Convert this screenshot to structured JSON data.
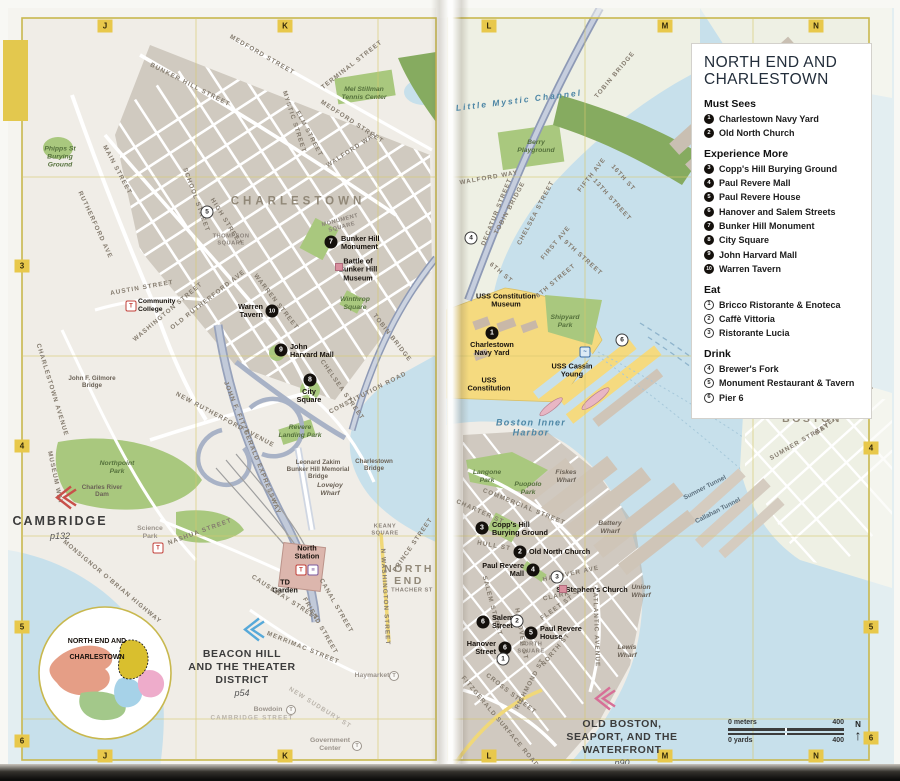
{
  "legend": {
    "title": "NORTH END AND\nCHARLESTOWN",
    "sections": [
      {
        "heading": "Must Sees",
        "style": "filled",
        "items": [
          {
            "n": "1",
            "t": "Charlestown Navy Yard"
          },
          {
            "n": "2",
            "t": "Old North Church"
          }
        ]
      },
      {
        "heading": "Experience More",
        "style": "filled",
        "items": [
          {
            "n": "3",
            "t": "Copp's Hill Burying Ground"
          },
          {
            "n": "4",
            "t": "Paul Revere Mall"
          },
          {
            "n": "5",
            "t": "Paul Revere House"
          },
          {
            "n": "6",
            "t": "Hanover and Salem Streets"
          },
          {
            "n": "7",
            "t": "Bunker Hill Monument"
          },
          {
            "n": "8",
            "t": "City Square"
          },
          {
            "n": "9",
            "t": "John Harvard Mall"
          },
          {
            "n": "10",
            "t": "Warren Tavern"
          }
        ]
      },
      {
        "heading": "Eat",
        "style": "outline",
        "items": [
          {
            "n": "1",
            "t": "Bricco Ristorante & Enoteca"
          },
          {
            "n": "2",
            "t": "Caffè Vittoria"
          },
          {
            "n": "3",
            "t": "Ristorante Lucia"
          }
        ]
      },
      {
        "heading": "Drink",
        "style": "outline",
        "items": [
          {
            "n": "4",
            "t": "Brewer's Fork"
          },
          {
            "n": "5",
            "t": "Monument Restaurant & Tavern"
          },
          {
            "n": "6",
            "t": "Pier 6"
          }
        ]
      }
    ]
  },
  "grid": {
    "top": [
      {
        "t": "J",
        "x": 105
      },
      {
        "t": "K",
        "x": 285
      },
      {
        "t": "L",
        "x": 489
      },
      {
        "t": "M",
        "x": 665
      },
      {
        "t": "N",
        "x": 816
      }
    ],
    "bottom": [
      {
        "t": "J",
        "x": 105
      },
      {
        "t": "K",
        "x": 285
      },
      {
        "t": "L",
        "x": 489
      },
      {
        "t": "M",
        "x": 665
      },
      {
        "t": "N",
        "x": 816
      }
    ],
    "left": [
      {
        "t": "3",
        "y": 266
      },
      {
        "t": "4",
        "y": 446
      },
      {
        "t": "5",
        "y": 627
      },
      {
        "t": "6",
        "y": 741
      }
    ],
    "right": [
      {
        "t": "4",
        "y": 448
      },
      {
        "t": "5",
        "y": 627
      },
      {
        "t": "6",
        "y": 738
      }
    ]
  },
  "scalebar": {
    "meters_left": "0 meters",
    "meters_right": "400",
    "yards_left": "0 yards",
    "yards_right": "400",
    "north": "N",
    "arrow": "↑"
  },
  "inset": {
    "title_line1": "NORTH END AND",
    "title_line2": "CHARLESTOWN"
  },
  "cross_refs": [
    {
      "name": "CAMBRIDGE",
      "page": "p132",
      "x": 60,
      "y": 514,
      "cx": 64,
      "cy": 500,
      "color": "#c8504a",
      "big": true
    },
    {
      "name": "BEACON HILL\nAND THE THEATER\nDISTRICT",
      "page": "p54",
      "x": 242,
      "y": 648,
      "cx": 252,
      "cy": 632,
      "color": "#57a9d9",
      "big": false
    },
    {
      "name": "OLD BOSTON,\nSEAPORT, AND THE\nWATERFRONT",
      "page": "p90",
      "x": 622,
      "y": 718,
      "cx": 603,
      "cy": 701,
      "color": "#d76f97",
      "big": false
    }
  ],
  "labels": [
    {
      "t": "CHARLESTOWN",
      "x": 298,
      "y": 202,
      "c": "district"
    },
    {
      "t": "NORTH\nEND",
      "x": 409,
      "y": 575,
      "c": "district2"
    },
    {
      "t": "EAST\nBOSTON",
      "x": 812,
      "y": 413,
      "c": "district2"
    },
    {
      "t": "Little Mystic Channel",
      "x": 519,
      "y": 101,
      "c": "water",
      "r": -7
    },
    {
      "t": "Boston Inner\nHarbor",
      "x": 531,
      "y": 428,
      "c": "water2"
    },
    {
      "t": "Mel Stillman\nTennis Center",
      "x": 364,
      "y": 94,
      "c": "park"
    },
    {
      "t": "Phipps St\nBurying\nGround",
      "x": 60,
      "y": 157,
      "c": "park"
    },
    {
      "t": "Winthrop\nSquare",
      "x": 355,
      "y": 304,
      "c": "park"
    },
    {
      "t": "Northpoint\nPark",
      "x": 117,
      "y": 468,
      "c": "park"
    },
    {
      "t": "Revere\nLanding Park",
      "x": 300,
      "y": 432,
      "c": "park"
    },
    {
      "t": "Berry\nPlayground",
      "x": 536,
      "y": 147,
      "c": "park"
    },
    {
      "t": "Shipyard\nPark",
      "x": 565,
      "y": 322,
      "c": "park"
    },
    {
      "t": "Langone\nPark",
      "x": 487,
      "y": 477,
      "c": "park"
    },
    {
      "t": "Puopolo\nPark",
      "x": 528,
      "y": 489,
      "c": "park"
    },
    {
      "t": "Lovejoy\nWharf",
      "x": 330,
      "y": 490,
      "c": "wharf"
    },
    {
      "t": "Fiskes\nWharf",
      "x": 566,
      "y": 477,
      "c": "wharf"
    },
    {
      "t": "Battery\nWharf",
      "x": 610,
      "y": 528,
      "c": "wharf"
    },
    {
      "t": "Union\nWharf",
      "x": 641,
      "y": 592,
      "c": "wharf"
    },
    {
      "t": "Lewis\nWharf",
      "x": 627,
      "y": 652,
      "c": "wharf"
    },
    {
      "t": "John F. Gilmore\nBridge",
      "x": 92,
      "y": 382,
      "c": "bridge"
    },
    {
      "t": "Charles River\nDam",
      "x": 102,
      "y": 491,
      "c": "bridge"
    },
    {
      "t": "Leonard Zakim\nBunker Hill Memorial\nBridge",
      "x": 318,
      "y": 470,
      "c": "bridge"
    },
    {
      "t": "Charlestown\nBridge",
      "x": 374,
      "y": 465,
      "c": "bridge"
    },
    {
      "t": "Battle of\nBunker Hill\nMuseum",
      "x": 358,
      "y": 270,
      "c": "poi"
    },
    {
      "t": "USS Constitution\nMuseum",
      "x": 506,
      "y": 301,
      "c": "poi"
    },
    {
      "t": "USS Cassin\nYoung",
      "x": 572,
      "y": 371,
      "c": "poi"
    },
    {
      "t": "USS\nConstitution",
      "x": 489,
      "y": 385,
      "c": "poi"
    },
    {
      "t": "St Stephen's Church",
      "x": 592,
      "y": 590,
      "c": "poi"
    },
    {
      "t": "TD\nGarden",
      "x": 285,
      "y": 587,
      "c": "poi"
    },
    {
      "t": "North\nStation",
      "x": 307,
      "y": 553,
      "c": "poi"
    },
    {
      "t": "NORTH\nSQUARE",
      "x": 531,
      "y": 648,
      "c": "squareLbl"
    },
    {
      "t": "THOMPSON\nSQUARE",
      "x": 231,
      "y": 240,
      "c": "squareLbl"
    },
    {
      "t": "MONUMENT\nSQUARE",
      "x": 341,
      "y": 224,
      "c": "squareLbl",
      "r": -15
    },
    {
      "t": "KEANY\nSQUARE",
      "x": 385,
      "y": 530,
      "c": "squareLbl"
    },
    {
      "t": "THACHER ST",
      "x": 412,
      "y": 591,
      "c": "squareLbl"
    },
    {
      "t": "Sumner Tunnel",
      "x": 705,
      "y": 488,
      "c": "tunnel",
      "r": -27
    },
    {
      "t": "Callahan Tunnel",
      "x": 718,
      "y": 511,
      "c": "tunnel",
      "r": -27
    },
    {
      "t": "MAIN STREET",
      "x": 117,
      "y": 170,
      "c": "street",
      "r": 62
    },
    {
      "t": "RUTHERFORD AVE",
      "x": 95,
      "y": 225,
      "c": "street",
      "r": 65
    },
    {
      "t": "BUNKER HILL STREET",
      "x": 190,
      "y": 85,
      "c": "street",
      "r": 27
    },
    {
      "t": "MEDFORD STREET",
      "x": 262,
      "y": 55,
      "c": "street",
      "r": 30
    },
    {
      "t": "MEDFORD STREET",
      "x": 352,
      "y": 122,
      "c": "street",
      "r": 33
    },
    {
      "t": "TERMINAL STREET",
      "x": 352,
      "y": 65,
      "c": "street",
      "r": -38
    },
    {
      "t": "MYSTIC STREET",
      "x": 294,
      "y": 122,
      "c": "street",
      "r": 72
    },
    {
      "t": "ELM STREET",
      "x": 309,
      "y": 134,
      "c": "street",
      "r": 62
    },
    {
      "t": "WALFORD WAY",
      "x": 352,
      "y": 150,
      "c": "street",
      "r": -33
    },
    {
      "t": "SCHOOL STREET",
      "x": 196,
      "y": 200,
      "c": "street",
      "r": 70
    },
    {
      "t": "HIGH STREET",
      "x": 226,
      "y": 222,
      "c": "street",
      "r": 58
    },
    {
      "t": "WARREN STREET",
      "x": 276,
      "y": 302,
      "c": "street",
      "r": 52
    },
    {
      "t": "AUSTIN STREET",
      "x": 142,
      "y": 288,
      "c": "street",
      "r": -10
    },
    {
      "t": "OLD RUTHERFORD AVE",
      "x": 208,
      "y": 300,
      "c": "street",
      "r": -38
    },
    {
      "t": "WASHINGTON STREET",
      "x": 168,
      "y": 312,
      "c": "street",
      "r": -40
    },
    {
      "t": "NEW RUTHERFORD AVENUE",
      "x": 225,
      "y": 420,
      "c": "street",
      "r": 28
    },
    {
      "t": "JOHN F. FITZGERALD EXPRESSWAY",
      "x": 252,
      "y": 448,
      "c": "street",
      "r": 68
    },
    {
      "t": "TOBIN BRIDGE",
      "x": 392,
      "y": 338,
      "c": "street",
      "r": 52
    },
    {
      "t": "CHELSEA STREET",
      "x": 342,
      "y": 390,
      "c": "street",
      "r": 55
    },
    {
      "t": "CONSTITUTION ROAD",
      "x": 368,
      "y": 393,
      "c": "street",
      "r": -27
    },
    {
      "t": "CHARLESTOWN AVENUE",
      "x": 52,
      "y": 390,
      "c": "street",
      "r": 73
    },
    {
      "t": "MUSEUM WAY",
      "x": 55,
      "y": 478,
      "c": "street",
      "r": 78
    },
    {
      "t": "MONSIGNOR O'BRIAN HIGHWAY",
      "x": 112,
      "y": 582,
      "c": "street",
      "r": 40
    },
    {
      "t": "NASHUA STREET",
      "x": 200,
      "y": 532,
      "c": "street",
      "r": -20
    },
    {
      "t": "CAUSEWAY STREET",
      "x": 285,
      "y": 598,
      "c": "street",
      "r": 33
    },
    {
      "t": "MERRIMAC STREET",
      "x": 303,
      "y": 648,
      "c": "street",
      "r": 22
    },
    {
      "t": "CANAL STREET",
      "x": 336,
      "y": 606,
      "c": "street",
      "r": 60
    },
    {
      "t": "FRIEND STREET",
      "x": 320,
      "y": 626,
      "c": "street",
      "r": 60
    },
    {
      "t": "N WASHINGTON STREET",
      "x": 385,
      "y": 597,
      "c": "street",
      "r": 87
    },
    {
      "t": "PRINCE STREET",
      "x": 413,
      "y": 545,
      "c": "street",
      "r": -55
    },
    {
      "t": "CAMBRIDGE STREET",
      "x": 252,
      "y": 718,
      "c": "streetFaded"
    },
    {
      "t": "NEW SUDBURY ST",
      "x": 320,
      "y": 708,
      "c": "streetFaded",
      "r": 32
    },
    {
      "t": "TOBIN BRIDGE",
      "x": 615,
      "y": 75,
      "c": "street",
      "r": -50
    },
    {
      "t": "TOBIN BRIDGE",
      "x": 510,
      "y": 208,
      "c": "street",
      "r": -62
    },
    {
      "t": "CHELSEA STREET",
      "x": 536,
      "y": 213,
      "c": "street",
      "r": -62
    },
    {
      "t": "WALFORD WAY",
      "x": 489,
      "y": 178,
      "c": "street",
      "r": -10
    },
    {
      "t": "DECATUR STREET",
      "x": 497,
      "y": 212,
      "c": "street",
      "r": -68
    },
    {
      "t": "FIFTH AVE",
      "x": 592,
      "y": 175,
      "c": "street",
      "r": -52
    },
    {
      "t": "FIRST AVE",
      "x": 556,
      "y": 243,
      "c": "street",
      "r": -50
    },
    {
      "t": "13TH STREET",
      "x": 612,
      "y": 200,
      "c": "street",
      "r": 48
    },
    {
      "t": "16TH ST",
      "x": 623,
      "y": 178,
      "c": "street",
      "r": 48
    },
    {
      "t": "9TH STREET",
      "x": 583,
      "y": 258,
      "c": "street",
      "r": 42
    },
    {
      "t": "8TH STREET",
      "x": 556,
      "y": 281,
      "c": "street",
      "r": -40
    },
    {
      "t": "6TH ST",
      "x": 501,
      "y": 273,
      "c": "street",
      "r": 40
    },
    {
      "t": "COMMERCIAL STREET",
      "x": 524,
      "y": 507,
      "c": "street",
      "r": 22
    },
    {
      "t": "CHARTER ST",
      "x": 480,
      "y": 512,
      "c": "street",
      "r": 24
    },
    {
      "t": "HULL ST",
      "x": 494,
      "y": 546,
      "c": "street",
      "r": 10
    },
    {
      "t": "SALEM STREET",
      "x": 492,
      "y": 606,
      "c": "street",
      "r": 75
    },
    {
      "t": "HANOVER ST",
      "x": 521,
      "y": 634,
      "c": "street",
      "r": 80
    },
    {
      "t": "HANOVER AVE",
      "x": 571,
      "y": 574,
      "c": "street",
      "r": -12
    },
    {
      "t": "CLARK ST",
      "x": 563,
      "y": 595,
      "c": "street",
      "r": -12
    },
    {
      "t": "FLEET ST",
      "x": 557,
      "y": 608,
      "c": "street",
      "r": -35
    },
    {
      "t": "NORTH ST",
      "x": 556,
      "y": 650,
      "c": "street",
      "r": -50
    },
    {
      "t": "RICHMOND ST",
      "x": 530,
      "y": 684,
      "c": "street",
      "r": -62
    },
    {
      "t": "ATLANTIC AVENUE",
      "x": 596,
      "y": 630,
      "c": "street",
      "r": 88
    },
    {
      "t": "CROSS STREET",
      "x": 511,
      "y": 694,
      "c": "street",
      "r": 38
    },
    {
      "t": "FITZGERALD SURFACE ROAD",
      "x": 500,
      "y": 722,
      "c": "street",
      "r": 50
    },
    {
      "t": "SUMNER STREET",
      "x": 800,
      "y": 442,
      "c": "street",
      "r": -30
    },
    {
      "t": "MAVERICK STREET",
      "x": 845,
      "y": 410,
      "c": "street",
      "r": -40
    }
  ],
  "markers": [
    {
      "n": "7",
      "x": 331,
      "y": 242,
      "type": "sight",
      "label": "Bunker Hill\nMonument",
      "lx": 341,
      "ly": 243,
      "la": "right"
    },
    {
      "n": "10",
      "x": 272,
      "y": 311,
      "type": "sight",
      "label": "Warren\nTavern",
      "lx": 263,
      "ly": 311,
      "la": "left"
    },
    {
      "n": "9",
      "x": 281,
      "y": 350,
      "type": "sight",
      "label": "John\nHarvard Mall",
      "lx": 290,
      "ly": 351,
      "la": "right"
    },
    {
      "n": "8",
      "x": 310,
      "y": 380,
      "type": "sight",
      "label": "City\nSquare",
      "lx": 309,
      "ly": 388,
      "la": "below"
    },
    {
      "n": "1",
      "x": 492,
      "y": 333,
      "type": "sight",
      "label": "Charlestown\nNavy Yard",
      "lx": 492,
      "ly": 341,
      "la": "below"
    },
    {
      "n": "3",
      "x": 482,
      "y": 528,
      "type": "sight",
      "label": "Copp's Hill\nBurying Ground",
      "lx": 492,
      "ly": 529,
      "la": "right"
    },
    {
      "n": "2",
      "x": 520,
      "y": 552,
      "type": "sight",
      "label": "Old North Church",
      "lx": 529,
      "ly": 552,
      "la": "right"
    },
    {
      "n": "4",
      "x": 533,
      "y": 570,
      "type": "sight",
      "label": "Paul Revere\nMall",
      "lx": 524,
      "ly": 570,
      "la": "left"
    },
    {
      "n": "6",
      "x": 483,
      "y": 622,
      "type": "sight",
      "label": "Salem\nStreet",
      "lx": 492,
      "ly": 622,
      "la": "right"
    },
    {
      "n": "5",
      "x": 531,
      "y": 633,
      "type": "sight",
      "label": "Paul Revere\nHouse",
      "lx": 540,
      "ly": 633,
      "la": "right"
    },
    {
      "n": "6",
      "x": 505,
      "y": 648,
      "type": "sight",
      "label": "Hanover\nStreet",
      "lx": 496,
      "ly": 648,
      "la": "left"
    },
    {
      "n": "1",
      "x": 503,
      "y": 659,
      "type": "eatdrink"
    },
    {
      "n": "2",
      "x": 517,
      "y": 621,
      "type": "eatdrink"
    },
    {
      "n": "3",
      "x": 557,
      "y": 577,
      "type": "eatdrink"
    },
    {
      "n": "4",
      "x": 471,
      "y": 238,
      "type": "eatdrink"
    },
    {
      "n": "5",
      "x": 207,
      "y": 212,
      "type": "eatdrink"
    },
    {
      "n": "6",
      "x": 622,
      "y": 340,
      "type": "eatdrink"
    }
  ],
  "icons": [
    {
      "type": "t-red",
      "glyph": "T",
      "x": 131,
      "y": 306,
      "name": "t-station-icon-community-college"
    },
    {
      "type": "t-red",
      "glyph": "T",
      "x": 158,
      "y": 548,
      "name": "t-station-icon-science-park"
    },
    {
      "type": "t-red",
      "glyph": "T",
      "x": 301,
      "y": 570,
      "name": "t-station-icon-north-station"
    },
    {
      "type": "t-purple",
      "glyph": "≡",
      "x": 313,
      "y": 570,
      "name": "commuter-rail-icon-north-station"
    },
    {
      "type": "t-ferry",
      "glyph": "~",
      "x": 585,
      "y": 352,
      "name": "ferry-icon"
    },
    {
      "type": "t-gray",
      "glyph": "T",
      "x": 291,
      "y": 710,
      "name": "t-station-icon-bowdoin"
    },
    {
      "type": "t-gray",
      "glyph": "T",
      "x": 394,
      "y": 676,
      "name": "t-station-icon-haymarket"
    },
    {
      "type": "t-gray",
      "glyph": "T",
      "x": 357,
      "y": 746,
      "name": "t-station-icon-government-center"
    },
    {
      "type": "site-sq",
      "glyph": "",
      "x": 339,
      "y": 267,
      "name": "museum-site-icon"
    },
    {
      "type": "site-sq",
      "glyph": "",
      "x": 563,
      "y": 589,
      "name": "church-site-icon"
    }
  ],
  "station_labels": [
    {
      "t": "Community\nCollege",
      "x": 138,
      "y": 306,
      "c": "station"
    },
    {
      "t": "Science\nPark",
      "x": 150,
      "y": 533,
      "c": "stationFaded2"
    },
    {
      "t": "Bowdoin",
      "x": 268,
      "y": 710,
      "c": "stationFaded"
    },
    {
      "t": "Haymarket",
      "x": 372,
      "y": 676,
      "c": "stationFaded"
    },
    {
      "t": "Government\nCenter",
      "x": 330,
      "y": 745,
      "c": "stationFaded"
    }
  ]
}
